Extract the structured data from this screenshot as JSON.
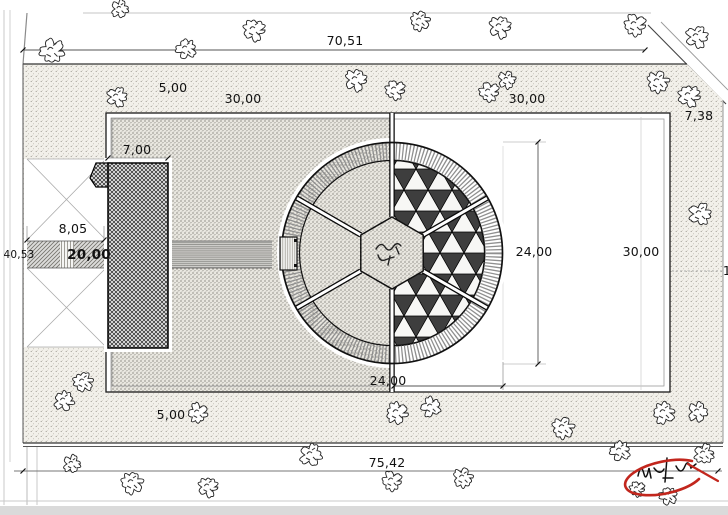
{
  "drawing": {
    "type": "architectural site plan",
    "accent_color": "#c2261d",
    "line_color": "#1a1a1a"
  },
  "dims": {
    "top_width": "70,51",
    "band_top": "5,00",
    "square_left": "30,00",
    "square_right_top": "30,00",
    "chamfer": "7,38",
    "building_width": "7,00",
    "entry_width": "8,05",
    "road_left": "40,53",
    "path_length": "20,00",
    "dome_vertical": "24,00",
    "right_width": "30,00",
    "dome_horizontal": "24,00",
    "band_bottom": "5,00",
    "bottom_width": "75,42",
    "edge_partial": "1"
  }
}
